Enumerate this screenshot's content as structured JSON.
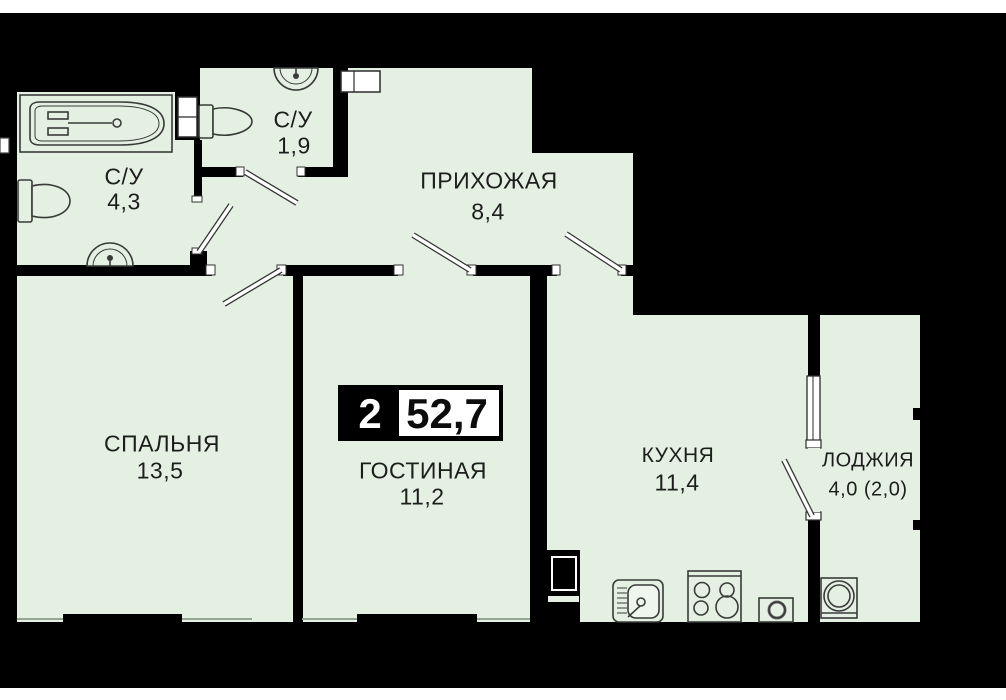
{
  "plan": {
    "title": "apartment floor plan",
    "badge": {
      "rooms": "2",
      "area": "52,7"
    },
    "rooms": [
      {
        "id": "bathroom",
        "label": "С/У",
        "area": "4,3"
      },
      {
        "id": "wc",
        "label": "С/У",
        "area": "1,9"
      },
      {
        "id": "hallway",
        "label": "ПРИХОЖАЯ",
        "area": "8,4"
      },
      {
        "id": "bedroom",
        "label": "СПАЛЬНЯ",
        "area": "13,5"
      },
      {
        "id": "living",
        "label": "ГОСТИНАЯ",
        "area": "11,2"
      },
      {
        "id": "kitchen",
        "label": "КУХНЯ",
        "area": "11,4"
      },
      {
        "id": "loggia",
        "label": "ЛОДЖИЯ",
        "area": "4,0 (2,0)"
      }
    ],
    "fixtures": [
      "bathtub",
      "toilet",
      "pedestal-sink",
      "toilet",
      "pedestal-sink",
      "kitchen-sink",
      "stove",
      "oven",
      "washing-machine",
      "ventilation-duct"
    ],
    "colors": {
      "background": "#000000",
      "floor": "#e4f1e2",
      "walls": "#000000",
      "fixture_outline": "#3a3a3a",
      "badge_box": "#ffffff",
      "page_margin": "#ffffff"
    }
  }
}
